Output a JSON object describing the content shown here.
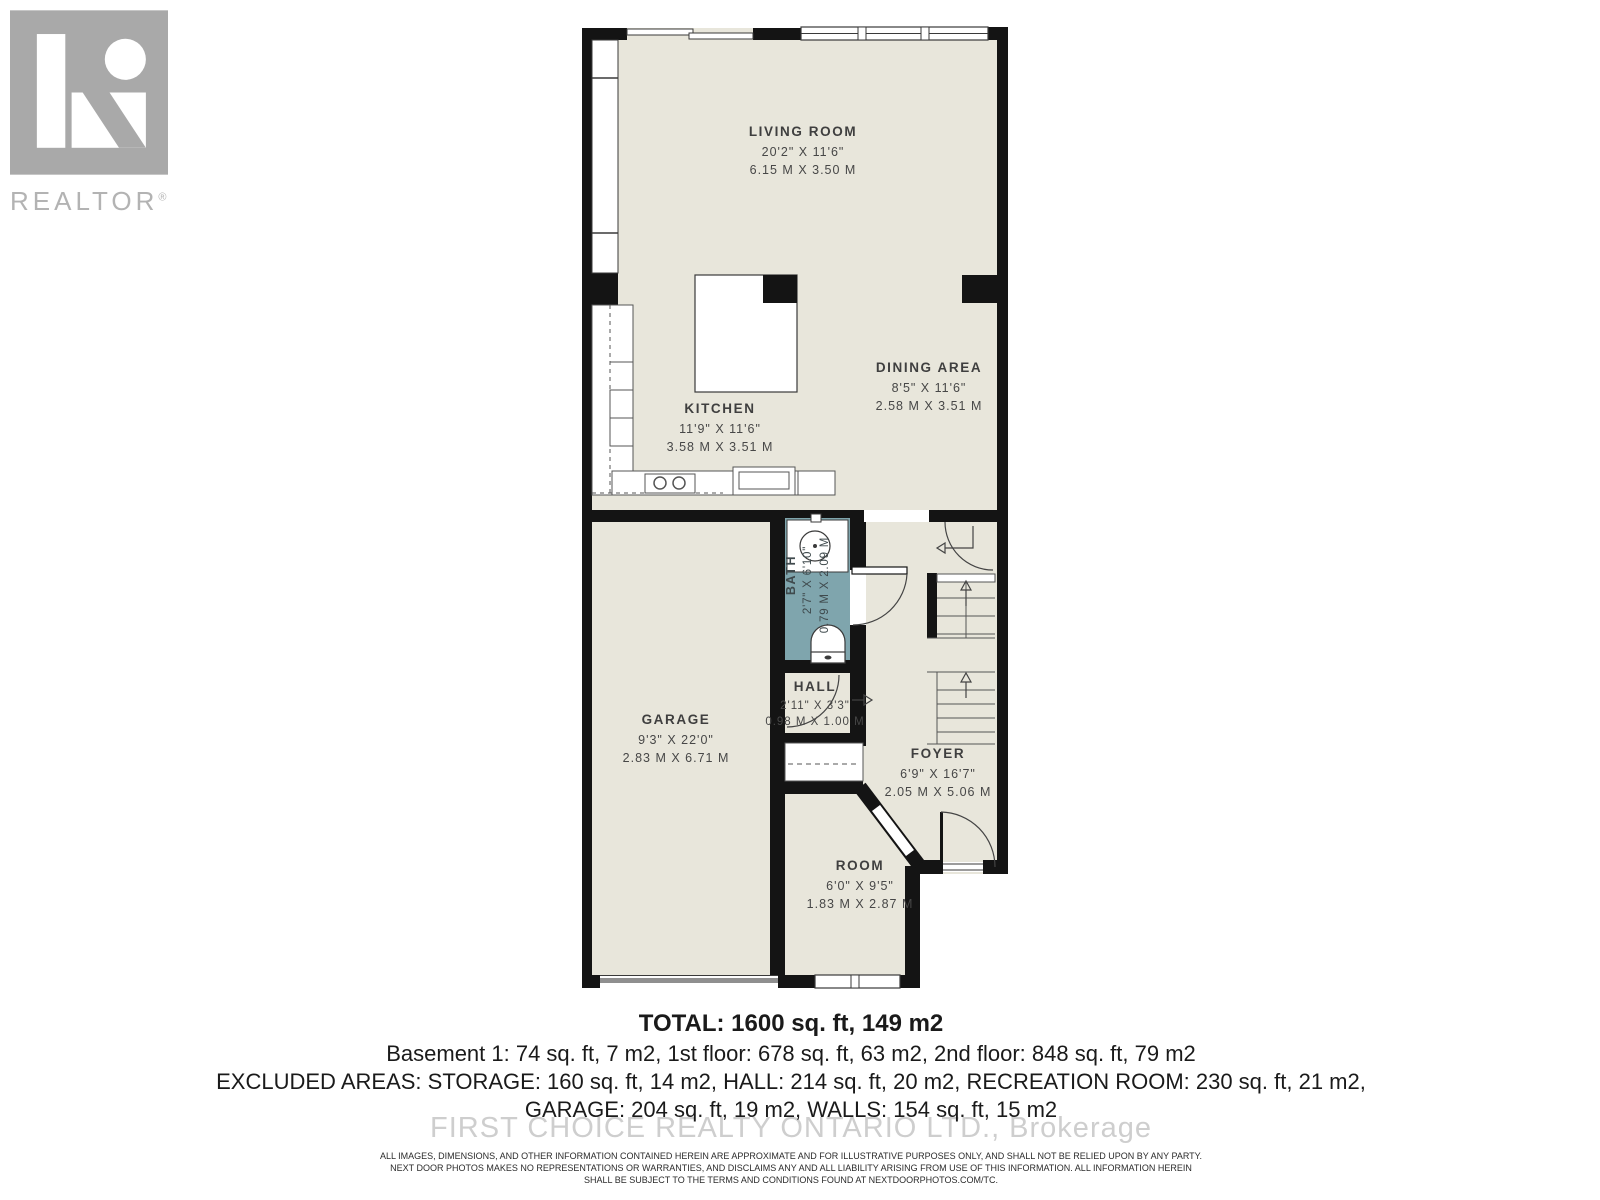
{
  "branding": {
    "logo_text": "REALTOR",
    "registered_mark": "®"
  },
  "watermark": "FIRST CHOICE REALTY ONTARIO LTD., Brokerage",
  "rooms": {
    "living_room": {
      "name": "LIVING ROOM",
      "imperial": "20'2\" X 11'6\"",
      "metric": "6.15 M X 3.50 M"
    },
    "dining_area": {
      "name": "DINING AREA",
      "imperial": "8'5\" X 11'6\"",
      "metric": "2.58 M X 3.51 M"
    },
    "kitchen": {
      "name": "KITCHEN",
      "imperial": "11'9\" X 11'6\"",
      "metric": "3.58 M X 3.51 M"
    },
    "garage": {
      "name": "GARAGE",
      "imperial": "9'3\" X 22'0\"",
      "metric": "2.83 M X 6.71 M"
    },
    "bath": {
      "name": "BATH",
      "imperial": "2'7\" X 6'10\"",
      "metric": "0.79 M X 2.09 M"
    },
    "hall": {
      "name": "HALL",
      "imperial": "2'11\" X 3'3\"",
      "metric": "0.98 M X 1.00 M"
    },
    "foyer": {
      "name": "FOYER",
      "imperial": "6'9\" X 16'7\"",
      "metric": "2.05 M X 5.06 M"
    },
    "room": {
      "name": "ROOM",
      "imperial": "6'0\" X 9'5\"",
      "metric": "1.83 M X 2.87 M"
    }
  },
  "summary": {
    "total": "TOTAL: 1600 sq. ft, 149 m2",
    "line2": "Basement 1: 74 sq. ft, 7 m2, 1st floor: 678 sq. ft, 63 m2, 2nd floor: 848 sq. ft, 79 m2",
    "line3": "EXCLUDED AREAS: STORAGE: 160 sq. ft, 14 m2, HALL: 214 sq. ft, 20 m2, RECREATION ROOM: 230 sq. ft, 21 m2,",
    "line4": "GARAGE: 204 sq. ft, 19 m2, WALLS: 154 sq. ft, 15 m2"
  },
  "disclaimer": {
    "line1": "ALL IMAGES, DIMENSIONS, AND OTHER INFORMATION CONTAINED HEREIN ARE APPROXIMATE AND FOR ILLUSTRATIVE PURPOSES ONLY, AND SHALL NOT BE RELIED UPON BY ANY PARTY.",
    "line2": "NEXT DOOR PHOTOS MAKES NO REPRESENTATIONS OR WARRANTIES, AND DISCLAIMS ANY AND ALL LIABILITY ARISING FROM USE OF THIS INFORMATION. ALL INFORMATION HEREIN",
    "line3": "SHALL BE SUBJECT TO THE TERMS AND CONDITIONS FOUND AT NEXTDOORPHOTOS.COM/TC."
  },
  "colors": {
    "floor": "#e8e6db",
    "bath": "#7fa5ad",
    "wall": "#141414",
    "label": "#454545"
  }
}
